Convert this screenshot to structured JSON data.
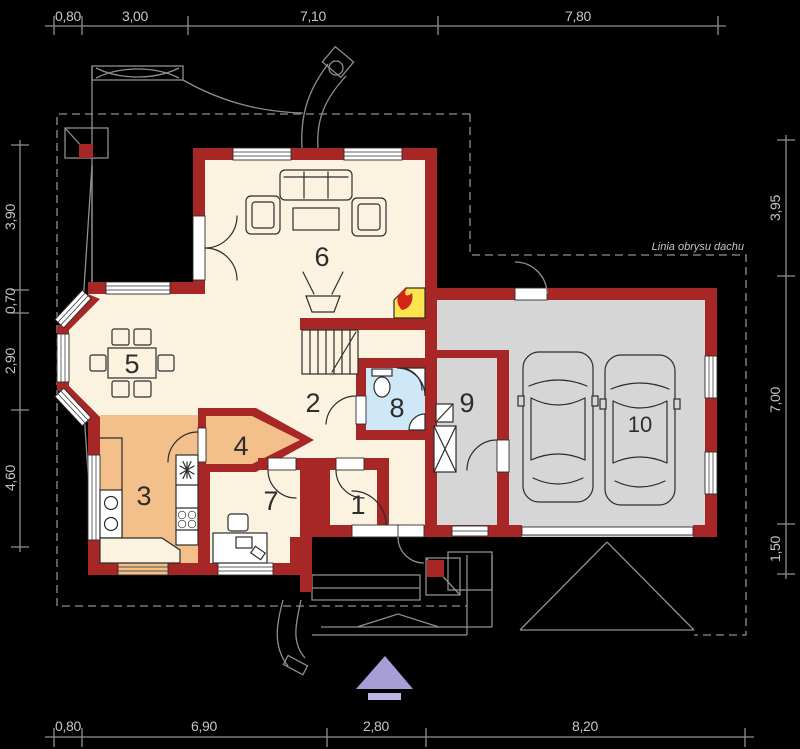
{
  "rulers": {
    "top": {
      "labels": [
        "0,80",
        "3,00",
        "7,10",
        "7,80"
      ]
    },
    "bottom": {
      "labels": [
        "0,80",
        "6,90",
        "2,80",
        "8,20"
      ]
    },
    "left": {
      "labels": [
        "3,90",
        "0,70",
        "2,90",
        "4,60"
      ]
    },
    "right": {
      "labels": [
        "3,95",
        "7,00",
        "1,50"
      ]
    }
  },
  "rooms": [
    {
      "number": "1"
    },
    {
      "number": "2"
    },
    {
      "number": "3"
    },
    {
      "number": "4"
    },
    {
      "number": "5"
    },
    {
      "number": "6"
    },
    {
      "number": "7"
    },
    {
      "number": "8"
    },
    {
      "number": "9"
    },
    {
      "number": "10"
    }
  ],
  "annotations": {
    "roof_outline_label": "Linia obrysu dachu"
  },
  "colors": {
    "background": "#000000",
    "wall": "#a62725",
    "cream": "#fbf2e0",
    "orange": "#f3bf8b",
    "blue": "#cfe8f8",
    "gray_floor": "#d6d6d6",
    "yellow": "#fbe44d",
    "flame": "#d22417",
    "line_dark": "#2d2d2d",
    "line_gray": "#8f8f8f",
    "text_gray": "#c6c6c6",
    "purple": "#a79ed7",
    "purple_light": "#beb3e4",
    "white": "#ffffff"
  }
}
